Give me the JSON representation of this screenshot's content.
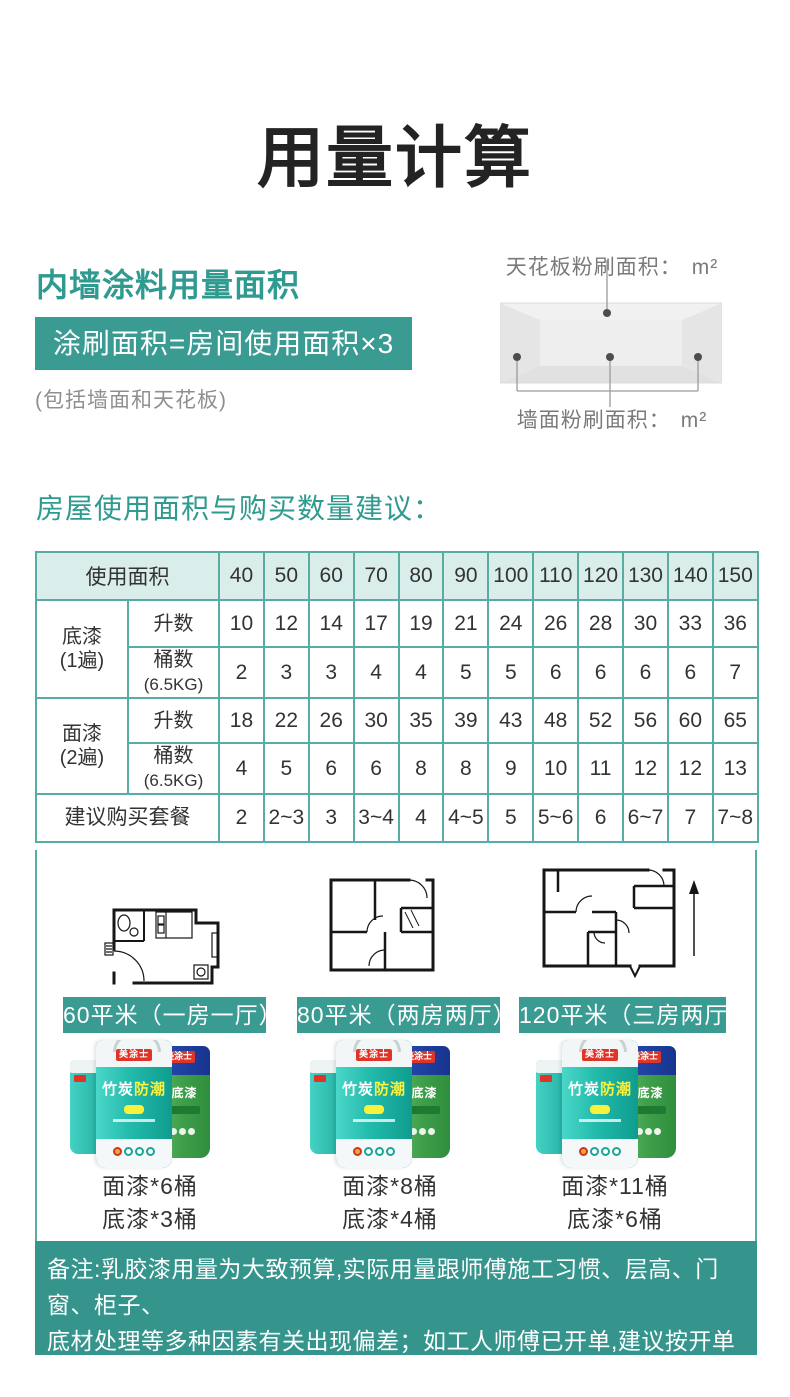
{
  "page": {
    "title": "用量计算"
  },
  "section1": {
    "heading": "内墙涂料用量面积",
    "formula": "涂刷面积=房间使用面积×3",
    "note": "(包括墙面和天花板)",
    "diagram": {
      "ceiling_label": "天花板粉刷面积：",
      "wall_label": "墙面粉刷面积：",
      "unit": "m²"
    }
  },
  "section2": {
    "heading": "房屋使用面积与购买数量建议：",
    "table": {
      "area_header": "使用面积",
      "areas": [
        "40",
        "50",
        "60",
        "70",
        "80",
        "90",
        "100",
        "110",
        "120",
        "130",
        "140",
        "150"
      ],
      "primer_name": "底漆",
      "primer_coats": "(1遍)",
      "top_name": "面漆",
      "top_coats": "(2遍)",
      "liters_label": "升数",
      "buckets_label": "桶数",
      "buckets_sub": "(6.5KG)",
      "primer_liters": [
        "10",
        "12",
        "14",
        "17",
        "19",
        "21",
        "24",
        "26",
        "28",
        "30",
        "33",
        "36"
      ],
      "primer_buckets": [
        "2",
        "3",
        "3",
        "4",
        "4",
        "5",
        "5",
        "6",
        "6",
        "6",
        "6",
        "7"
      ],
      "top_liters": [
        "18",
        "22",
        "26",
        "30",
        "35",
        "39",
        "43",
        "48",
        "52",
        "56",
        "60",
        "65"
      ],
      "top_buckets": [
        "4",
        "5",
        "6",
        "6",
        "8",
        "8",
        "9",
        "10",
        "11",
        "12",
        "12",
        "13"
      ],
      "suggest_label": "建议购买套餐",
      "suggest": [
        "2",
        "2~3",
        "3",
        "3~4",
        "4",
        "4~5",
        "5",
        "5~6",
        "6",
        "6~7",
        "7",
        "7~8"
      ]
    },
    "plans": [
      {
        "label": "60平米（一房一厅）",
        "topcoat": "面漆*6桶",
        "primer": "底漆*3桶"
      },
      {
        "label": "80平米（两房两厅）",
        "topcoat": "面漆*8桶",
        "primer": "底漆*4桶"
      },
      {
        "label": "120平米（三房两厅）",
        "topcoat": "面漆*11桶",
        "primer": "底漆*6桶"
      }
    ],
    "bucket": {
      "brand": "美涂士",
      "name_white": "竹炭",
      "name_yellow": "防潮",
      "primer_text": "保底漆"
    }
  },
  "footer": {
    "line1": "备注:乳胶漆用量为大致预算,实际用量跟师傅施工习惯、层高、门窗、柜子、",
    "line2": "底材处理等多种因素有关出现偏差；如工人师傅已开单,建议按开单数量购买。",
    "line3": "更多疑问、单桶补货,请联系客服。"
  },
  "colors": {
    "accent_teal": "#3a9b93",
    "table_border": "#58aca4",
    "table_header_bg": "#d9edea",
    "note_gray": "#8f8f8f"
  }
}
